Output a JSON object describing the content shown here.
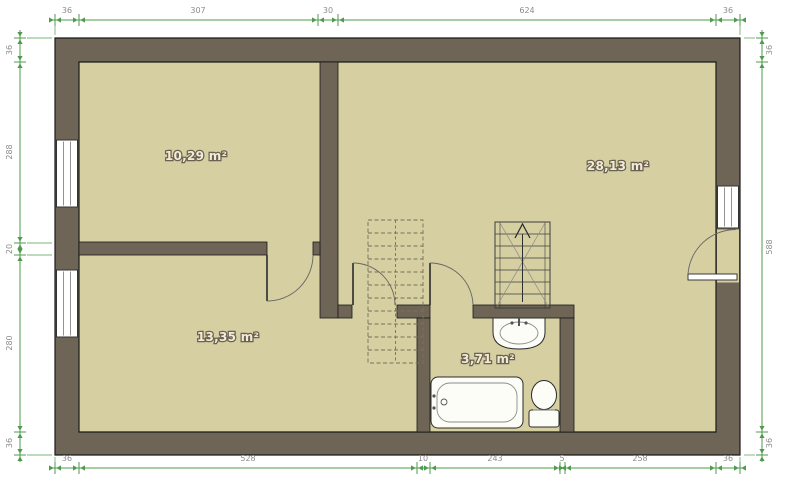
{
  "plan": {
    "rooms": [
      {
        "name": "room-upper-left",
        "area_label": "10,29 m²"
      },
      {
        "name": "room-right",
        "area_label": "28,13 m²"
      },
      {
        "name": "room-lower-left",
        "area_label": "13,35 m²"
      },
      {
        "name": "bathroom",
        "area_label": "3,71 m²"
      }
    ],
    "dimensions": {
      "top": [
        "36",
        "307",
        "30",
        "624",
        "36"
      ],
      "bottom": [
        "36",
        "528",
        "10",
        "243",
        "5",
        "258",
        "36"
      ],
      "left": [
        "36",
        "288",
        "20",
        "280",
        "36"
      ],
      "right": [
        "36",
        "588",
        "36"
      ]
    },
    "fixtures": [
      "bathtub",
      "toilet",
      "sink",
      "staircase-up-arrow",
      "staircase-dashed"
    ],
    "colors": {
      "wall": "#6e6556",
      "floor": "#d6cfa2",
      "dimension_line": "#4e9b4e",
      "dimension_text": "#8c8c8c",
      "room_label": "#f1ecd8",
      "fixture_fill": "#fdfdf8"
    }
  }
}
